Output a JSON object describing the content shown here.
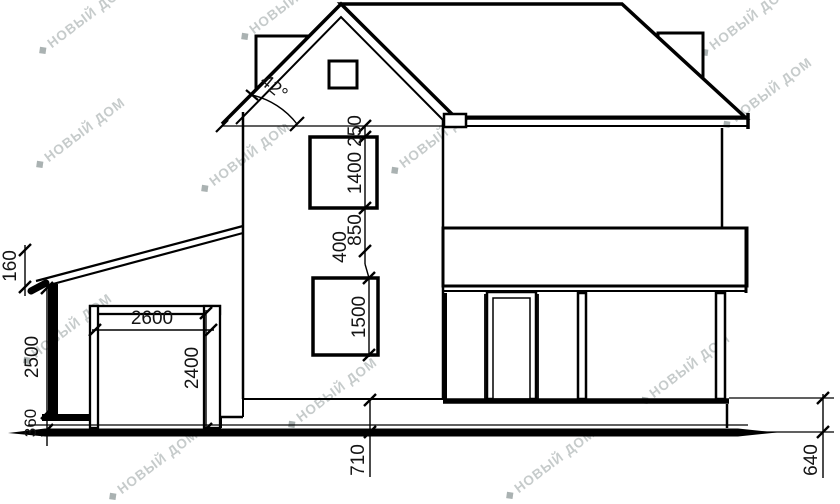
{
  "drawing": {
    "title_hint": "house side elevation",
    "angle_label": "42°",
    "dimensions": {
      "d160": "160",
      "d2500": "2500",
      "d360": "360",
      "d2600": "2600",
      "d2400": "2400",
      "d250": "250",
      "d1400": "1400",
      "d850": "850",
      "d400": "400",
      "d1500": "1500",
      "d710": "710",
      "d640": "640"
    },
    "watermark": {
      "text": "НОВЫЙ ДОМ",
      "icon_glyph": "◆",
      "color": "#78828233"
    },
    "colors": {
      "line": "#000000",
      "background": "#ffffff",
      "dimension_text": "#141414"
    }
  }
}
